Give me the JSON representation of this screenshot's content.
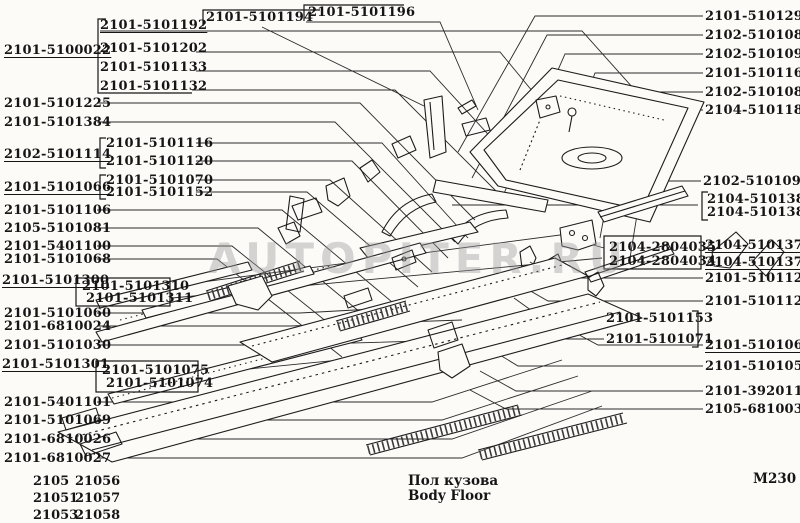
{
  "watermark": "AUTOPITER.RU",
  "labels": {
    "main_assembly": "2101-5100022",
    "group_a": [
      "2101-5101192",
      "2101-5101202",
      "2101-5101133",
      "2101-5101132"
    ],
    "top_mid": [
      "2101-5101194",
      "2101-5101196"
    ],
    "left_a": [
      "2101-5101225",
      "2101-5101384"
    ],
    "group_b": [
      "2101-5101116",
      "2101-5101120"
    ],
    "left_b": "2102-5101114",
    "group_c": [
      "2101-5101070",
      "2101-5101152"
    ],
    "left_c": "2101-5101066",
    "left_d": [
      "2101-5101106",
      "2105-5101081",
      "2101-5401100",
      "2101-5101068"
    ],
    "left_e": "2101-5101300",
    "group_d": [
      "2101-5101310",
      "2101-5101311"
    ],
    "left_f": [
      "2101-5101060",
      "2101-6810024",
      "2101-5101030"
    ],
    "left_g": "2101-5101301",
    "group_e": [
      "2101-5101075",
      "2101-5101074"
    ],
    "left_h": [
      "2101-5401101",
      "2101-5101069",
      "2101-6810026",
      "2101-6810027"
    ],
    "top_right": [
      "2101-5101290",
      "2102-5101086",
      "2102-5101092",
      "2101-5101169",
      "2102-5101082",
      "2104-5101182"
    ],
    "right_a": "2102-5101091",
    "group_f": [
      "2104-5101381",
      "2104-5101380"
    ],
    "group_g": [
      "2104-2804035",
      "2104-2804034"
    ],
    "right_b": [
      "2104-5101373",
      "2104-5101372"
    ],
    "right_c": [
      "2101-5101122",
      "2101-5101126"
    ],
    "group_h": [
      "2101-5101153",
      "2101-5101071"
    ],
    "right_d": "2101-5101067",
    "right_e": [
      "2101-5101050",
      "2101-3920110",
      "2105-6810030"
    ]
  },
  "footer": {
    "title_ru": "Пол кузова",
    "title_en": "Body Floor",
    "sheet_code": "M230",
    "model_table": [
      [
        "2105",
        "21056"
      ],
      [
        "21051",
        "21057"
      ],
      [
        "21053",
        "21058"
      ]
    ]
  }
}
